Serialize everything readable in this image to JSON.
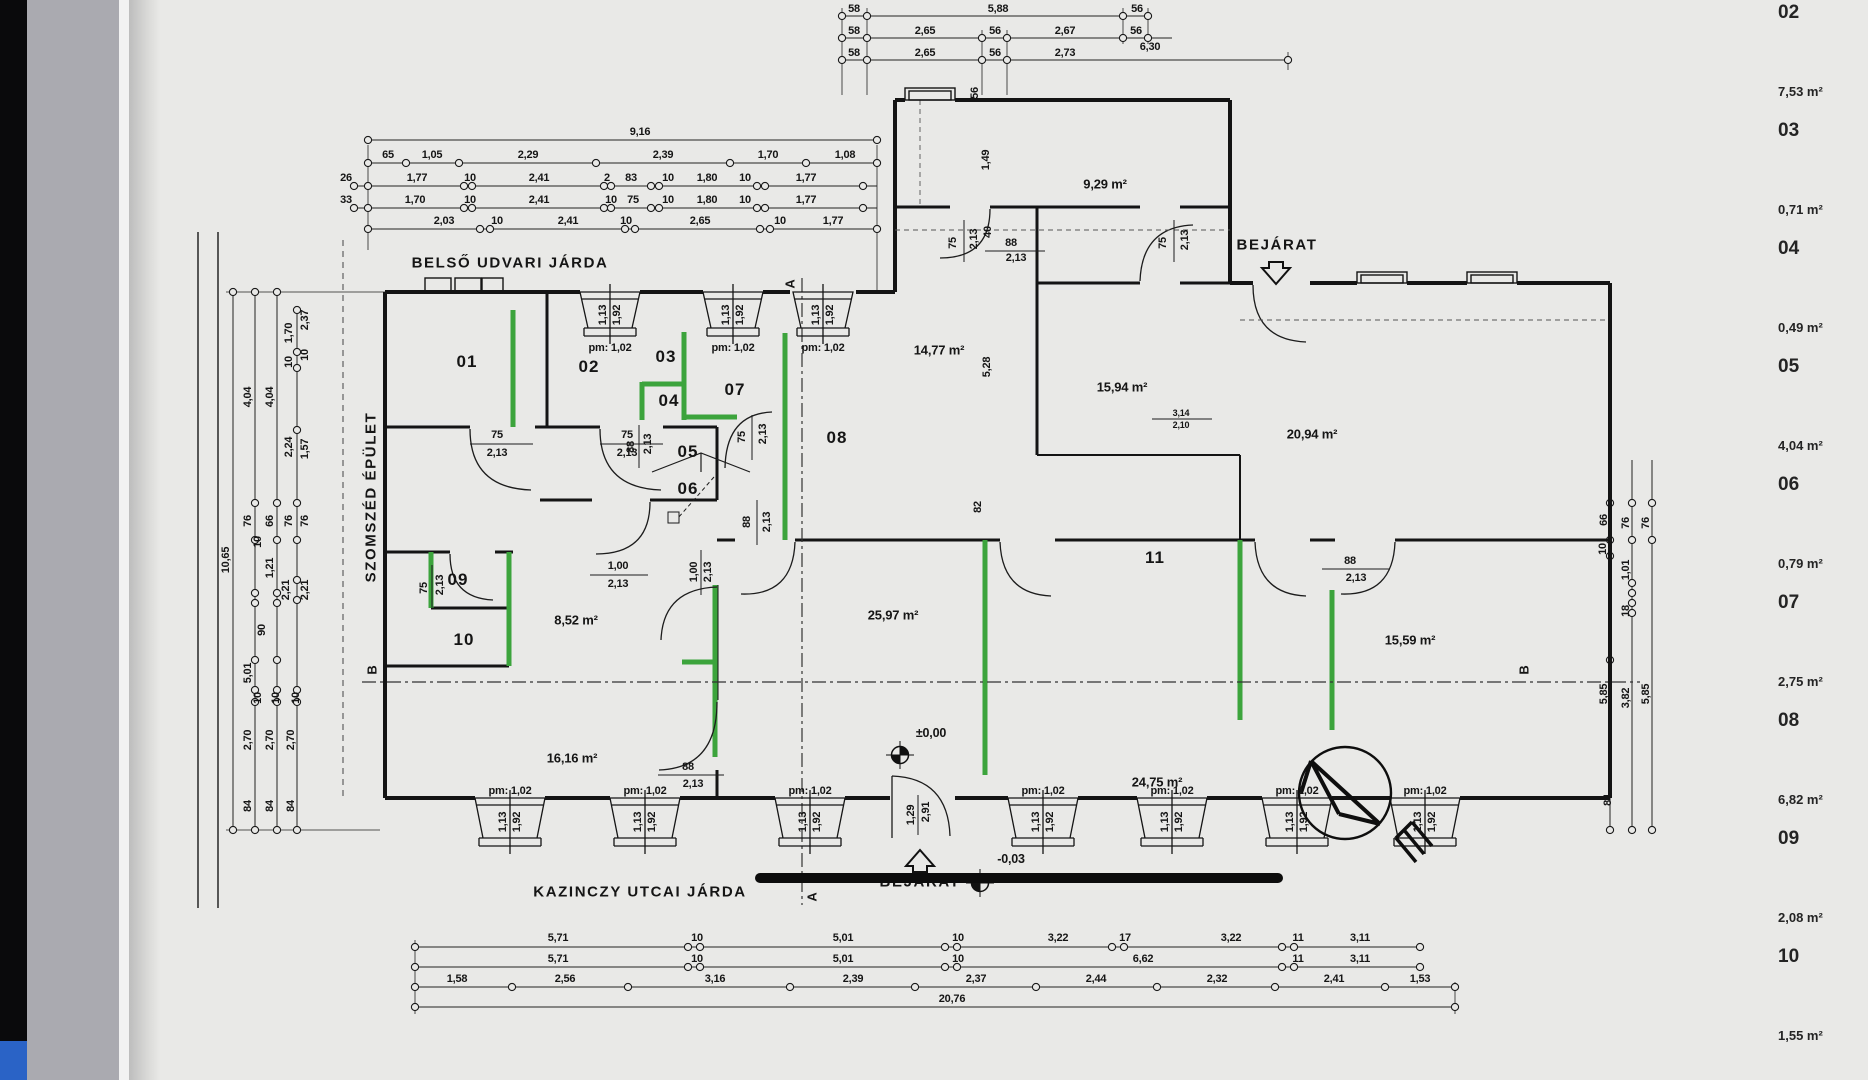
{
  "colors": {
    "highlight_green": "#3ca43c",
    "paper": "#e9e9e7",
    "ink": "#151515",
    "chrome_blue": "#2a63c6",
    "chrome_black": "#0a0a0c"
  },
  "schedule": {
    "items": [
      {
        "num": "02",
        "area": "7,53 m²"
      },
      {
        "num": "03",
        "area": "0,71 m²"
      },
      {
        "num": "04",
        "area": "0,49 m²"
      },
      {
        "num": "05",
        "area": "4,04 m²"
      },
      {
        "num": "06",
        "area": "0,79 m²"
      },
      {
        "num": "07",
        "area": "2,75 m²"
      },
      {
        "num": "08",
        "area": "6,82 m²"
      },
      {
        "num": "09",
        "area": "2,08 m²"
      },
      {
        "num": "10",
        "area": "1,55 m²"
      }
    ]
  },
  "plan": {
    "labels": [
      {
        "t": "58",
        "x": 854,
        "y": 9
      },
      {
        "t": "5,88",
        "x": 998,
        "y": 9
      },
      {
        "t": "56",
        "x": 1137,
        "y": 9
      },
      {
        "t": "58",
        "x": 854,
        "y": 31
      },
      {
        "t": "2,65",
        "x": 925,
        "y": 31
      },
      {
        "t": "56",
        "x": 995,
        "y": 31
      },
      {
        "t": "2,67",
        "x": 1065,
        "y": 31
      },
      {
        "t": "56",
        "x": 1136,
        "y": 31
      },
      {
        "t": "58",
        "x": 854,
        "y": 53
      },
      {
        "t": "2,65",
        "x": 925,
        "y": 53
      },
      {
        "t": "56",
        "x": 995,
        "y": 53
      },
      {
        "t": "2,73",
        "x": 1065,
        "y": 53
      },
      {
        "t": "6,30",
        "x": 1150,
        "y": 47
      },
      {
        "t": "9,16",
        "x": 640,
        "y": 132
      },
      {
        "t": "65",
        "x": 388,
        "y": 155
      },
      {
        "t": "1,05",
        "x": 432,
        "y": 155
      },
      {
        "t": "2,29",
        "x": 528,
        "y": 155
      },
      {
        "t": "2,39",
        "x": 663,
        "y": 155
      },
      {
        "t": "1,70",
        "x": 768,
        "y": 155
      },
      {
        "t": "1,08",
        "x": 845,
        "y": 155
      },
      {
        "t": "26",
        "x": 346,
        "y": 178
      },
      {
        "t": "1,77",
        "x": 417,
        "y": 178
      },
      {
        "t": "10",
        "x": 470,
        "y": 178
      },
      {
        "t": "2,41",
        "x": 539,
        "y": 178
      },
      {
        "t": "2",
        "x": 607,
        "y": 178
      },
      {
        "t": "83",
        "x": 631,
        "y": 178
      },
      {
        "t": "10",
        "x": 668,
        "y": 178
      },
      {
        "t": "1,80",
        "x": 707,
        "y": 178
      },
      {
        "t": "10",
        "x": 745,
        "y": 178
      },
      {
        "t": "1,77",
        "x": 806,
        "y": 178
      },
      {
        "t": "33",
        "x": 346,
        "y": 200
      },
      {
        "t": "1,70",
        "x": 415,
        "y": 200
      },
      {
        "t": "10",
        "x": 470,
        "y": 200
      },
      {
        "t": "2,41",
        "x": 539,
        "y": 200
      },
      {
        "t": "10",
        "x": 611,
        "y": 200
      },
      {
        "t": "75",
        "x": 633,
        "y": 200
      },
      {
        "t": "10",
        "x": 668,
        "y": 200
      },
      {
        "t": "1,80",
        "x": 707,
        "y": 200
      },
      {
        "t": "10",
        "x": 745,
        "y": 200
      },
      {
        "t": "1,77",
        "x": 806,
        "y": 200
      },
      {
        "t": "2,03",
        "x": 444,
        "y": 221
      },
      {
        "t": "10",
        "x": 497,
        "y": 221
      },
      {
        "t": "2,41",
        "x": 568,
        "y": 221
      },
      {
        "t": "10",
        "x": 626,
        "y": 221
      },
      {
        "t": "2,65",
        "x": 700,
        "y": 221
      },
      {
        "t": "10",
        "x": 780,
        "y": 221
      },
      {
        "t": "1,77",
        "x": 833,
        "y": 221
      },
      {
        "t": "10,65",
        "x": 226,
        "y": 560,
        "r": 1
      },
      {
        "t": "4,04",
        "x": 248,
        "y": 397,
        "r": 1
      },
      {
        "t": "4,04",
        "x": 270,
        "y": 397,
        "r": 1
      },
      {
        "t": "1,70",
        "x": 289,
        "y": 333,
        "r": 1
      },
      {
        "t": "2,37",
        "x": 305,
        "y": 320,
        "r": 1
      },
      {
        "t": "10",
        "x": 289,
        "y": 362,
        "r": 1
      },
      {
        "t": "10",
        "x": 305,
        "y": 355,
        "r": 1
      },
      {
        "t": "2,24",
        "x": 289,
        "y": 447,
        "r": 1
      },
      {
        "t": "1,57",
        "x": 305,
        "y": 449,
        "r": 1
      },
      {
        "t": "76",
        "x": 248,
        "y": 521,
        "r": 1
      },
      {
        "t": "66",
        "x": 270,
        "y": 521,
        "r": 1
      },
      {
        "t": "76",
        "x": 289,
        "y": 521,
        "r": 1
      },
      {
        "t": "76",
        "x": 305,
        "y": 521,
        "r": 1
      },
      {
        "t": "10",
        "x": 258,
        "y": 542,
        "r": 1
      },
      {
        "t": "1,21",
        "x": 270,
        "y": 568,
        "r": 1
      },
      {
        "t": "2,21",
        "x": 286,
        "y": 590,
        "r": 1
      },
      {
        "t": "2,21",
        "x": 305,
        "y": 590,
        "r": 1
      },
      {
        "t": "90",
        "x": 262,
        "y": 630,
        "r": 1
      },
      {
        "t": "5,01",
        "x": 248,
        "y": 673,
        "r": 1
      },
      {
        "t": "10",
        "x": 258,
        "y": 698,
        "r": 1
      },
      {
        "t": "10",
        "x": 276,
        "y": 698,
        "r": 1
      },
      {
        "t": "10",
        "x": 296,
        "y": 698,
        "r": 1
      },
      {
        "t": "2,70",
        "x": 248,
        "y": 740,
        "r": 1
      },
      {
        "t": "2,70",
        "x": 270,
        "y": 740,
        "r": 1
      },
      {
        "t": "2,70",
        "x": 291,
        "y": 740,
        "r": 1
      },
      {
        "t": "84",
        "x": 248,
        "y": 806,
        "r": 1
      },
      {
        "t": "84",
        "x": 270,
        "y": 806,
        "r": 1
      },
      {
        "t": "84",
        "x": 291,
        "y": 806,
        "r": 1
      },
      {
        "t": "66",
        "x": 1604,
        "y": 520,
        "r": 1
      },
      {
        "t": "76",
        "x": 1626,
        "y": 523,
        "r": 1
      },
      {
        "t": "76",
        "x": 1646,
        "y": 523,
        "r": 1
      },
      {
        "t": "10",
        "x": 1603,
        "y": 549,
        "r": 1
      },
      {
        "t": "1,01",
        "x": 1626,
        "y": 570,
        "r": 1
      },
      {
        "t": "18",
        "x": 1626,
        "y": 611,
        "r": 1
      },
      {
        "t": "5,85",
        "x": 1604,
        "y": 694,
        "r": 1
      },
      {
        "t": "3,82",
        "x": 1626,
        "y": 698,
        "r": 1
      },
      {
        "t": "5,85",
        "x": 1646,
        "y": 694,
        "r": 1
      },
      {
        "t": "84",
        "x": 1608,
        "y": 800,
        "r": 1
      },
      {
        "t": "5,71",
        "x": 558,
        "y": 938
      },
      {
        "t": "10",
        "x": 697,
        "y": 938
      },
      {
        "t": "5,01",
        "x": 843,
        "y": 938
      },
      {
        "t": "10",
        "x": 958,
        "y": 938
      },
      {
        "t": "3,22",
        "x": 1058,
        "y": 938
      },
      {
        "t": "17",
        "x": 1125,
        "y": 938
      },
      {
        "t": "3,22",
        "x": 1231,
        "y": 938
      },
      {
        "t": "11",
        "x": 1298,
        "y": 938
      },
      {
        "t": "3,11",
        "x": 1360,
        "y": 938
      },
      {
        "t": "5,71",
        "x": 558,
        "y": 959
      },
      {
        "t": "10",
        "x": 697,
        "y": 959
      },
      {
        "t": "5,01",
        "x": 843,
        "y": 959
      },
      {
        "t": "10",
        "x": 958,
        "y": 959
      },
      {
        "t": "6,62",
        "x": 1143,
        "y": 959
      },
      {
        "t": "11",
        "x": 1298,
        "y": 959
      },
      {
        "t": "3,11",
        "x": 1360,
        "y": 959
      },
      {
        "t": "1,58",
        "x": 457,
        "y": 979
      },
      {
        "t": "2,56",
        "x": 565,
        "y": 979
      },
      {
        "t": "3,16",
        "x": 715,
        "y": 979
      },
      {
        "t": "2,39",
        "x": 853,
        "y": 979
      },
      {
        "t": "2,37",
        "x": 976,
        "y": 979
      },
      {
        "t": "2,44",
        "x": 1096,
        "y": 979
      },
      {
        "t": "2,32",
        "x": 1217,
        "y": 979
      },
      {
        "t": "2,41",
        "x": 1334,
        "y": 979
      },
      {
        "t": "1,53",
        "x": 1420,
        "y": 979
      },
      {
        "t": "20,76",
        "x": 952,
        "y": 999
      },
      {
        "t": "BELSŐ UDVARI JÁRDA",
        "x": 510,
        "y": 263,
        "c": "title"
      },
      {
        "t": "SZOMSZÉD ÉPÜLET",
        "x": 371,
        "y": 497,
        "r": 1,
        "c": "title"
      },
      {
        "t": "KAZINCZY UTCAI JÁRDA",
        "x": 640,
        "y": 892,
        "c": "title"
      },
      {
        "t": "BEJÁRAT",
        "x": 1277,
        "y": 245,
        "c": "title"
      },
      {
        "t": "BEJÁRAT",
        "x": 920,
        "y": 882,
        "c": "title"
      },
      {
        "t": "01",
        "x": 467,
        "y": 362,
        "c": "room"
      },
      {
        "t": "02",
        "x": 589,
        "y": 367,
        "c": "room"
      },
      {
        "t": "03",
        "x": 666,
        "y": 357,
        "c": "room"
      },
      {
        "t": "04",
        "x": 669,
        "y": 401,
        "c": "room"
      },
      {
        "t": "05",
        "x": 688,
        "y": 452,
        "c": "room"
      },
      {
        "t": "06",
        "x": 688,
        "y": 489,
        "c": "room"
      },
      {
        "t": "07",
        "x": 735,
        "y": 390,
        "c": "room"
      },
      {
        "t": "08",
        "x": 837,
        "y": 438,
        "c": "room"
      },
      {
        "t": "09",
        "x": 458,
        "y": 580,
        "c": "room"
      },
      {
        "t": "10",
        "x": 464,
        "y": 640,
        "c": "room"
      },
      {
        "t": "11",
        "x": 1155,
        "y": 558,
        "c": "room"
      },
      {
        "t": "9,29 m²",
        "x": 1105,
        "y": 184,
        "c": "area"
      },
      {
        "t": "14,77 m²",
        "x": 939,
        "y": 350,
        "c": "area"
      },
      {
        "t": "15,94 m²",
        "x": 1122,
        "y": 387,
        "c": "area"
      },
      {
        "t": "20,94 m²",
        "x": 1312,
        "y": 434,
        "c": "area"
      },
      {
        "t": "8,52 m²",
        "x": 576,
        "y": 620,
        "c": "area"
      },
      {
        "t": "25,97 m²",
        "x": 893,
        "y": 615,
        "c": "area"
      },
      {
        "t": "16,16 m²",
        "x": 572,
        "y": 758,
        "c": "area"
      },
      {
        "t": "24,75 m²",
        "x": 1157,
        "y": 782,
        "c": "area"
      },
      {
        "t": "15,59 m²",
        "x": 1410,
        "y": 640,
        "c": "area"
      },
      {
        "t": "±0,00",
        "x": 931,
        "y": 733,
        "c": "lvl"
      },
      {
        "t": "-0,03",
        "x": 1011,
        "y": 859,
        "c": "lvl"
      },
      {
        "t": "A",
        "x": 790,
        "y": 284,
        "r": 1,
        "c": "sec"
      },
      {
        "t": "A",
        "x": 812,
        "y": 897,
        "r": 1,
        "c": "sec"
      },
      {
        "t": "B",
        "x": 372,
        "y": 670,
        "r": 1,
        "c": "sec"
      },
      {
        "t": "B",
        "x": 1524,
        "y": 670,
        "r": 1,
        "c": "sec"
      },
      {
        "t": "75",
        "x": 497,
        "y": 435
      },
      {
        "t": "2,13",
        "x": 497,
        "y": 453
      },
      {
        "t": "75",
        "x": 627,
        "y": 435
      },
      {
        "t": "2,13",
        "x": 627,
        "y": 453
      },
      {
        "t": "75",
        "x": 742,
        "y": 437,
        "r": 1
      },
      {
        "t": "2,13",
        "x": 763,
        "y": 434,
        "r": 1
      },
      {
        "t": "88",
        "x": 747,
        "y": 522,
        "r": 1
      },
      {
        "t": "2,13",
        "x": 767,
        "y": 522,
        "r": 1
      },
      {
        "t": "1,00",
        "x": 618,
        "y": 566
      },
      {
        "t": "2,13",
        "x": 618,
        "y": 584
      },
      {
        "t": "1,00",
        "x": 694,
        "y": 572,
        "r": 1
      },
      {
        "t": "2,13",
        "x": 708,
        "y": 572,
        "r": 1
      },
      {
        "t": "88",
        "x": 1011,
        "y": 243
      },
      {
        "t": "2,13",
        "x": 1016,
        "y": 258
      },
      {
        "t": "75",
        "x": 953,
        "y": 243,
        "r": 1
      },
      {
        "t": "2,13",
        "x": 974,
        "y": 239,
        "r": 1
      },
      {
        "t": "40",
        "x": 988,
        "y": 232,
        "r": 1
      },
      {
        "t": "75",
        "x": 1163,
        "y": 243,
        "r": 1
      },
      {
        "t": "2,13",
        "x": 1185,
        "y": 240,
        "r": 1
      },
      {
        "t": "88",
        "x": 1350,
        "y": 561
      },
      {
        "t": "2,13",
        "x": 1356,
        "y": 578
      },
      {
        "t": "88",
        "x": 688,
        "y": 767
      },
      {
        "t": "2,13",
        "x": 693,
        "y": 784
      },
      {
        "t": "1,29",
        "x": 911,
        "y": 815,
        "r": 1
      },
      {
        "t": "2,91",
        "x": 926,
        "y": 812,
        "r": 1
      },
      {
        "t": "3,14",
        "x": 1181,
        "y": 413,
        "c": "sm"
      },
      {
        "t": "2,10",
        "x": 1181,
        "y": 425,
        "c": "sm"
      },
      {
        "t": "88",
        "x": 631,
        "y": 447,
        "r": 1
      },
      {
        "t": "2,13",
        "x": 648,
        "y": 444,
        "r": 1
      },
      {
        "t": "75",
        "x": 424,
        "y": 588,
        "r": 1
      },
      {
        "t": "2,13",
        "x": 440,
        "y": 585,
        "r": 1
      },
      {
        "t": "1,49",
        "x": 986,
        "y": 160,
        "r": 1
      },
      {
        "t": "5,28",
        "x": 987,
        "y": 367,
        "r": 1
      },
      {
        "t": "56",
        "x": 975,
        "y": 93,
        "r": 1
      },
      {
        "t": "82",
        "x": 978,
        "y": 507,
        "r": 1
      },
      {
        "t": "pm: 1,02",
        "x": 610,
        "y": 348,
        "c": "pm"
      },
      {
        "t": "1,13",
        "x": 603,
        "y": 315,
        "r": 1
      },
      {
        "t": "1,92",
        "x": 617,
        "y": 315,
        "r": 1
      },
      {
        "t": "pm: 1,02",
        "x": 733,
        "y": 348,
        "c": "pm"
      },
      {
        "t": "1,13",
        "x": 726,
        "y": 315,
        "r": 1
      },
      {
        "t": "1,92",
        "x": 740,
        "y": 315,
        "r": 1
      },
      {
        "t": "pm: 1,02",
        "x": 823,
        "y": 348,
        "c": "pm"
      },
      {
        "t": "1,13",
        "x": 816,
        "y": 315,
        "r": 1
      },
      {
        "t": "1,92",
        "x": 830,
        "y": 315,
        "r": 1
      },
      {
        "t": "pm: 1,02",
        "x": 510,
        "y": 791,
        "c": "pm"
      },
      {
        "t": "1,13",
        "x": 503,
        "y": 822,
        "r": 1
      },
      {
        "t": "1,92",
        "x": 517,
        "y": 822,
        "r": 1
      },
      {
        "t": "pm: 1,02",
        "x": 645,
        "y": 791,
        "c": "pm"
      },
      {
        "t": "1,13",
        "x": 638,
        "y": 822,
        "r": 1
      },
      {
        "t": "1,92",
        "x": 652,
        "y": 822,
        "r": 1
      },
      {
        "t": "pm: 1,02",
        "x": 810,
        "y": 791,
        "c": "pm"
      },
      {
        "t": "1,13",
        "x": 803,
        "y": 822,
        "r": 1
      },
      {
        "t": "1,92",
        "x": 817,
        "y": 822,
        "r": 1
      },
      {
        "t": "pm: 1,02",
        "x": 1043,
        "y": 791,
        "c": "pm"
      },
      {
        "t": "1,13",
        "x": 1036,
        "y": 822,
        "r": 1
      },
      {
        "t": "1,92",
        "x": 1050,
        "y": 822,
        "r": 1
      },
      {
        "t": "pm: 1,02",
        "x": 1172,
        "y": 791,
        "c": "pm"
      },
      {
        "t": "1,13",
        "x": 1165,
        "y": 822,
        "r": 1
      },
      {
        "t": "1,92",
        "x": 1179,
        "y": 822,
        "r": 1
      },
      {
        "t": "pm: 1,02",
        "x": 1297,
        "y": 791,
        "c": "pm"
      },
      {
        "t": "1,13",
        "x": 1290,
        "y": 822,
        "r": 1
      },
      {
        "t": "1,92",
        "x": 1304,
        "y": 822,
        "r": 1
      },
      {
        "t": "pm: 1,02",
        "x": 1425,
        "y": 791,
        "c": "pm"
      },
      {
        "t": "1,13",
        "x": 1418,
        "y": 822,
        "r": 1
      },
      {
        "t": "1,92",
        "x": 1432,
        "y": 822,
        "r": 1
      }
    ]
  }
}
